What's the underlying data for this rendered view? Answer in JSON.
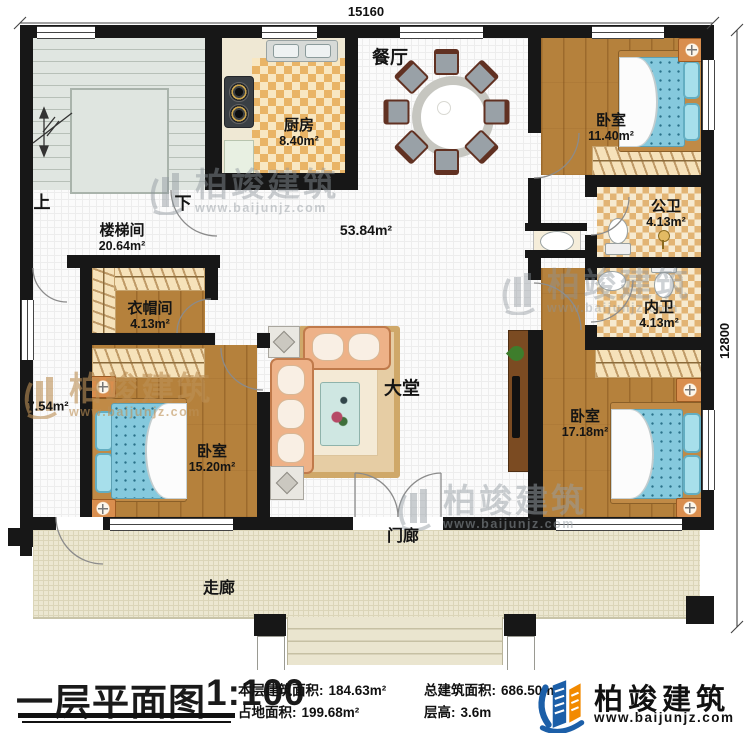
{
  "plan": {
    "dimension_top": "15160",
    "dimension_right": "12800",
    "stair_up": "上",
    "stair_down": "下",
    "rooms": [
      {
        "name": "楼梯间",
        "area": "20.64m²"
      },
      {
        "name": "厨房",
        "area": "8.40m²"
      },
      {
        "name": "餐厅",
        "area": ""
      },
      {
        "name": "",
        "area": "53.84m²"
      },
      {
        "name": "卧室",
        "area": "11.40m²"
      },
      {
        "name": "公卫",
        "area": "4.13m²"
      },
      {
        "name": "内卫",
        "area": "4.13m²"
      },
      {
        "name": "卧室",
        "area": "17.18m²"
      },
      {
        "name": "衣帽间",
        "area": "4.13m²"
      },
      {
        "name": "卧室",
        "area": "15.20m²"
      },
      {
        "name": "",
        "area": "7.54m²"
      },
      {
        "name": "大堂",
        "area": ""
      },
      {
        "name": "门廊",
        "area": ""
      },
      {
        "name": "走廊",
        "area": ""
      }
    ],
    "watermark": {
      "name": "柏竣建筑",
      "url": "www.baijunjz.com"
    }
  },
  "footer": {
    "title": "一层平面图",
    "scale": "1:100",
    "stats": [
      {
        "label": "本层建筑面积:",
        "value": "184.63m²"
      },
      {
        "label": "占地面积:",
        "value": "199.68m²"
      },
      {
        "label": "总建筑面积:",
        "value": "686.50m²"
      },
      {
        "label": "层高:",
        "value": "3.6m"
      }
    ],
    "brand": {
      "name": "柏竣建筑",
      "url": "www.baijunjz.com"
    }
  }
}
